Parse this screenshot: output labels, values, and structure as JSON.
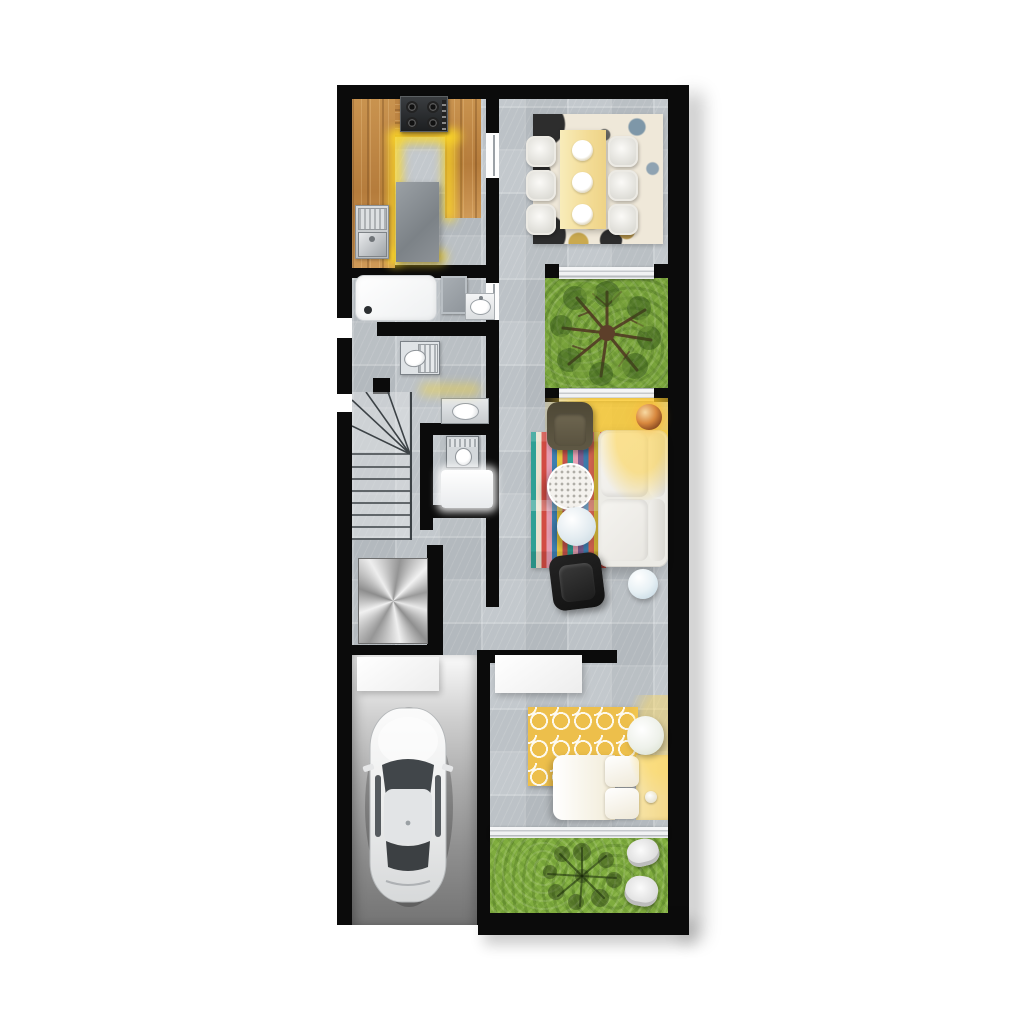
{
  "scene": {
    "type": "architectural-floor-plan-render",
    "view": "top-down",
    "text_labels": [],
    "rooms": [
      {
        "name": "kitchen",
        "furniture": [
          "l-shaped-wood-counter",
          "gas-stove-4-burner",
          "double-sink",
          "gray-island",
          "yellow-led-counter-glow"
        ]
      },
      {
        "name": "dining-room",
        "furniture": [
          "area-rug-abstract",
          "rectangular-table-cream",
          "plates",
          "dining-chairs"
        ]
      },
      {
        "name": "bathroom-1",
        "furniture": [
          "shower-tray",
          "bath-mat",
          "washbasin"
        ]
      },
      {
        "name": "wc",
        "furniture": [
          "toilet"
        ]
      },
      {
        "name": "staircase",
        "furniture": [
          "winder-treads",
          "straight-treads"
        ]
      },
      {
        "name": "bathroom-2",
        "furniture": [
          "washbasin",
          "toilet",
          "shower"
        ]
      },
      {
        "name": "courtyard",
        "furniture": [
          "grass",
          "tree-top-view",
          "glass-sliding-doors"
        ]
      },
      {
        "name": "living-room",
        "furniture": [
          "striped-rug",
          "olive-armchair",
          "white-l-sofa",
          "round-coffee-table-dotted",
          "round-coffee-table-blue",
          "black-armchair",
          "ball-side-table",
          "disco-ball-lamp",
          "sunlight-glow"
        ]
      },
      {
        "name": "utility",
        "furniture": [
          "brushed-metal-platform"
        ]
      },
      {
        "name": "garage",
        "furniture": [
          "white-car-top-view",
          "storage-shelf",
          "concrete-driveway"
        ]
      },
      {
        "name": "bedroom",
        "furniture": [
          "wardrobe",
          "yellow-ogee-rug",
          "bed-with-pillows",
          "round-pouf",
          "glass-sliding-door"
        ]
      },
      {
        "name": "back-garden",
        "furniture": [
          "grass",
          "tree-shadow",
          "garden-chairs"
        ]
      }
    ]
  },
  "counts": {
    "dining_chairs": 6,
    "dining_plates": 3,
    "stair_straight_treads": 7,
    "stair_winder_treads": 4,
    "coffee_tables": 2,
    "garden_chairs": 2,
    "bed_pillows": 2,
    "cars": 1
  },
  "palette": {
    "wall": "#0b0b0b",
    "tile": "#c8cdd1",
    "wood": "#c08a4c",
    "glowYellow": "#fcd826",
    "grass": "#79a43b",
    "grassShadow": "#2f4a14",
    "garageLight": "#f5f5f5",
    "garageDark": "#757575",
    "metal": "#c9c9c9",
    "sofaWhite": "#f1efeb",
    "oliveChair": "#574f3d",
    "blackChair": "#191919",
    "rugCream": "#efe8d9",
    "rugYellow": "#edbf4b",
    "bedYellow": "#f5de9e",
    "tableCream": "#f6e3a8",
    "treeTrunk": "#5d3f2a",
    "carBody": "#f2f3f4"
  }
}
